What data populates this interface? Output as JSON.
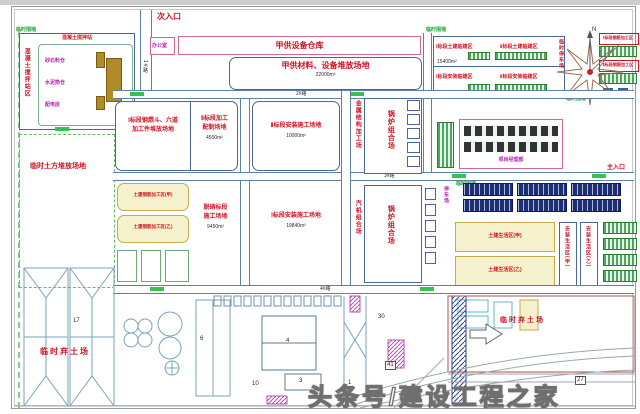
{
  "watermark": "头条号/建设工程之家",
  "entrances": {
    "secondary": "次入口",
    "main": "主入口"
  },
  "compass": {
    "north": "N"
  },
  "fence_label": "临时围墙",
  "roads": {
    "r1": "1#路",
    "r2": "2#路",
    "r3": "3#路",
    "r4": "4#路"
  },
  "top_row": {
    "office": "办公室",
    "warehouse": "甲供设备仓库"
  },
  "batching_plant": {
    "side_label": "混凝土搅拌站区",
    "title": "混凝土搅拌站",
    "bins": [
      "砂石料仓",
      "水泥筒仓",
      "配电房"
    ]
  },
  "camp": {
    "cells": [
      "Ⅰ标段土建临建区",
      "Ⅱ标段土建临建区",
      "Ⅰ标段安装临建区",
      "Ⅱ标段安装临建区"
    ],
    "area": "15400m²",
    "parking_side": "临时停车场"
  },
  "right_strip": {
    "labels": [
      "Ⅰ标段钢筋加工区",
      "Ⅱ标段钢筋加工区"
    ]
  },
  "areas": {
    "materials": {
      "name": "甲供材料、设备堆放场地",
      "area": "22000m²"
    },
    "zone1_steel": {
      "name": "Ⅰ标段钢煨斗、六道",
      "name2": "加工件堆放场地"
    },
    "zone2_process": {
      "name": "Ⅱ标段加工",
      "name2": "配制场地",
      "area": "4500m²"
    },
    "zone2_install": {
      "name": "Ⅱ标段安装施工场地",
      "area": "10000m²"
    },
    "denitration": {
      "name": "脱硝标段",
      "name2": "施工场地",
      "area": "9450m²"
    },
    "zone1_install": {
      "name": "Ⅰ标段安装施工场地",
      "area": "19840m²"
    },
    "temp_earth": {
      "name": "临时土方堆放场地"
    },
    "spoil_left": {
      "name": "临时弃土场"
    },
    "spoil_right": {
      "name": "临时弃土场"
    }
  },
  "rebar_sheds": {
    "a": "土建钢筋加工区(甲)",
    "b": "土建钢筋加工区(乙)"
  },
  "yards": {
    "metal": "金属结构加工场",
    "boiler1": "锅炉组合场",
    "boiler2": "锅炉组合场",
    "turbine": "汽机组合场"
  },
  "office_compound": {
    "label": "项目经理部"
  },
  "living": {
    "parking": "停车场",
    "cells": [
      "土建生活区(甲)",
      "土建生活区(乙)",
      "安装生活区(甲)",
      "安装生活区(乙)"
    ]
  },
  "plant_numbers": {
    "n17": "17",
    "n6": "6",
    "n4": "4",
    "n3": "3",
    "n1": "1",
    "n10": "10",
    "n30": "30",
    "n41": "41",
    "n27": "27"
  }
}
